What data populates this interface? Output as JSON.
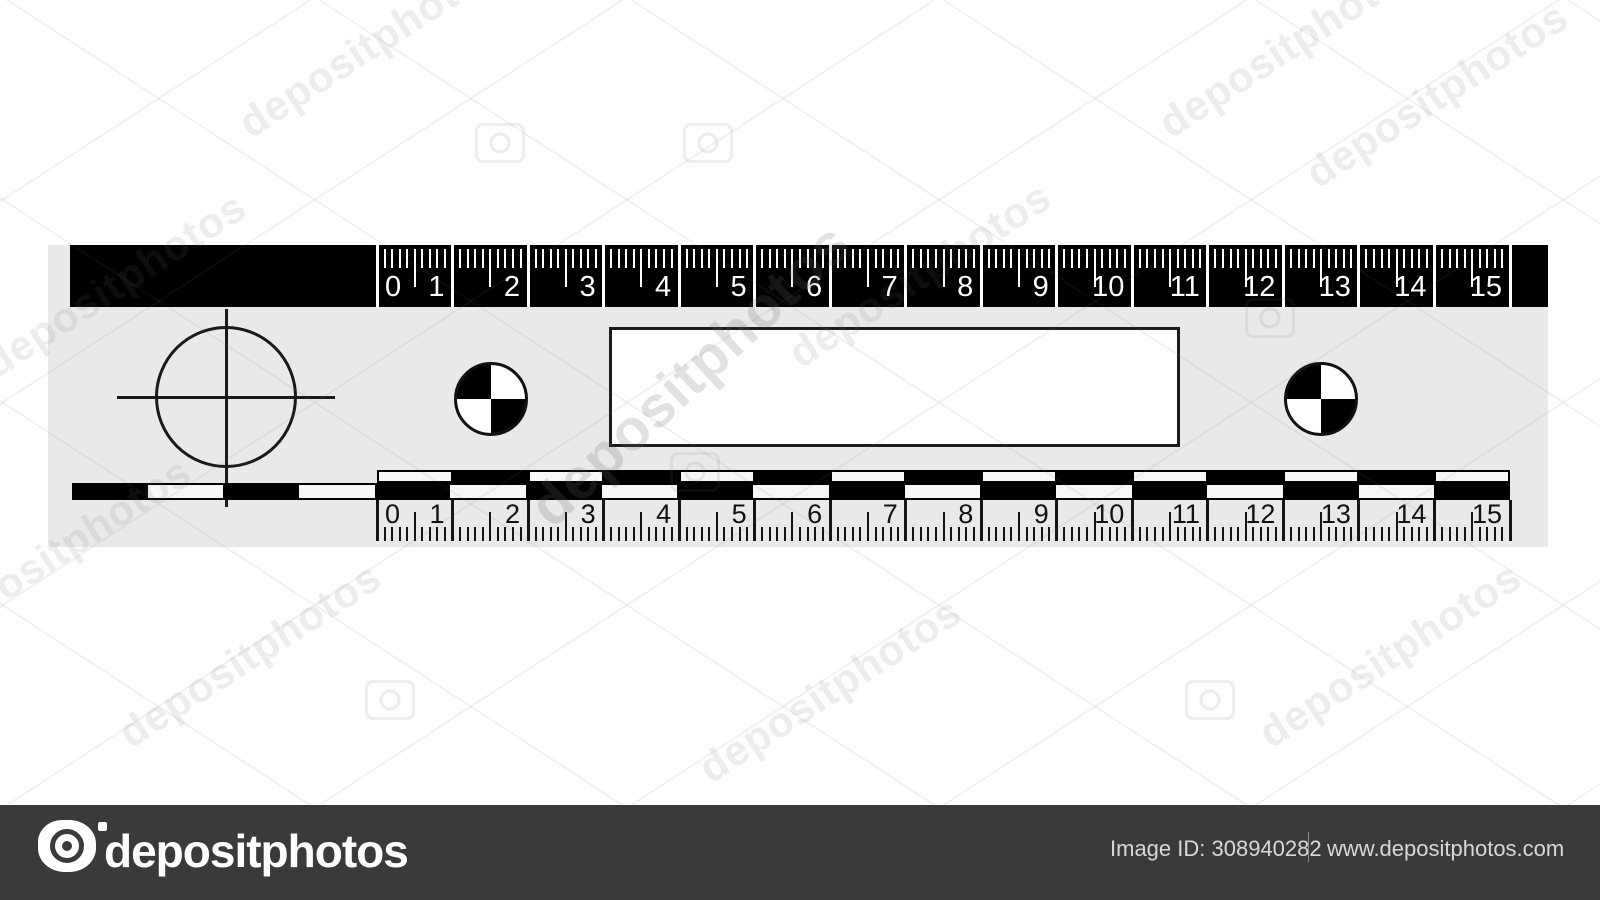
{
  "ruler": {
    "unit_numbers": [
      "0",
      "1",
      "2",
      "3",
      "4",
      "5",
      "6",
      "7",
      "8",
      "9",
      "10",
      "11",
      "12",
      "13",
      "14",
      "15"
    ],
    "body_color": "#e9e9e9",
    "band_color": "#000000",
    "top_tick_color": "#ffffff",
    "bottom_tick_color": "#141414",
    "checker_white": "#f7f7f7"
  },
  "watermark": {
    "tile_text": "depositphotos",
    "center_text": "depositphotos",
    "bottom_bar": {
      "background": "#3a3a3a",
      "logo_text": "depositphotos",
      "image_id": "Image ID: 308940282",
      "website": "www.depositphotos.com"
    }
  }
}
